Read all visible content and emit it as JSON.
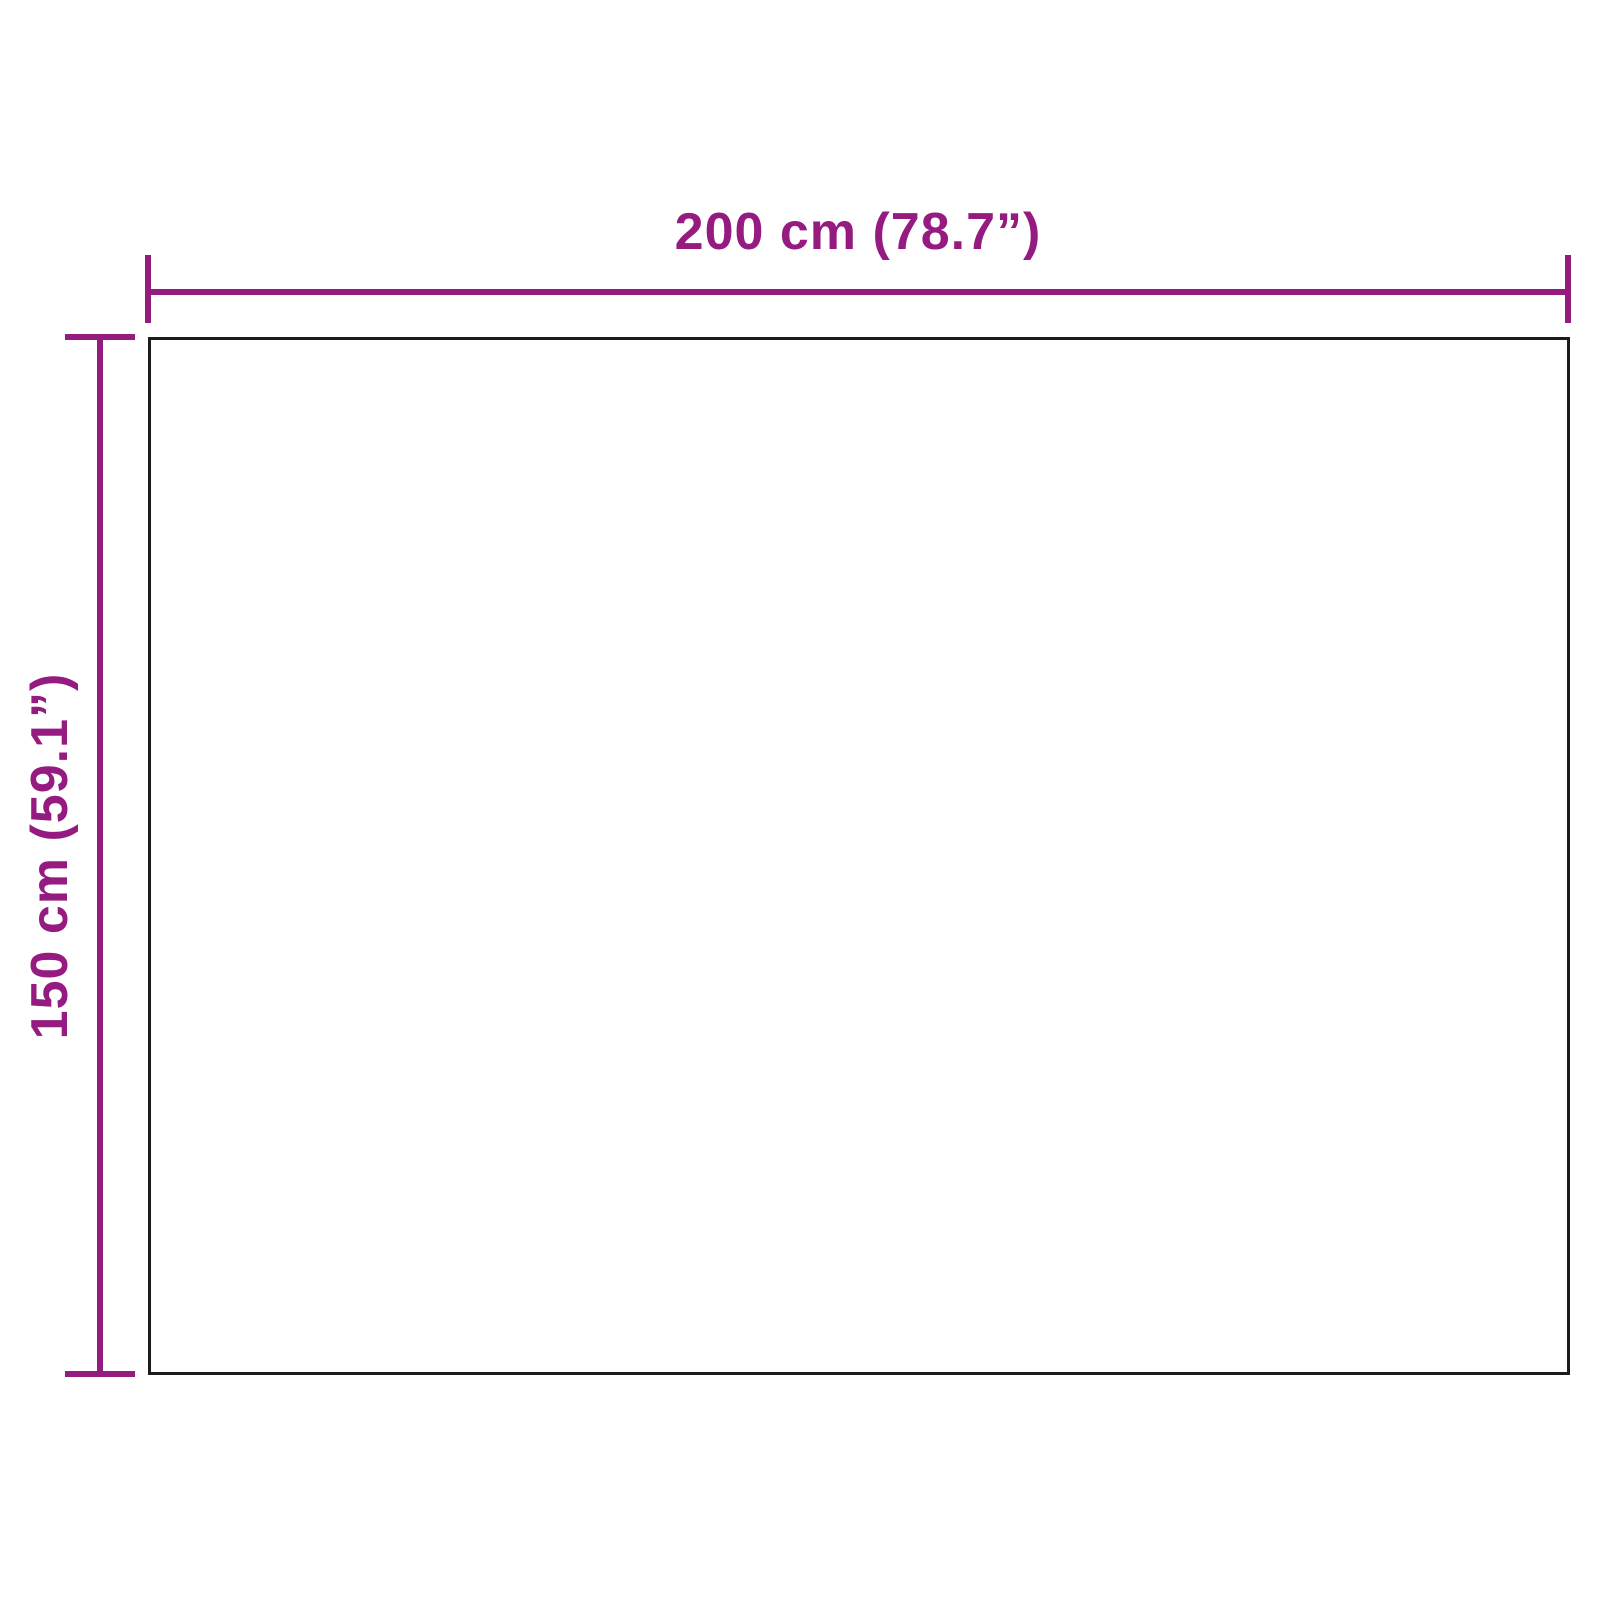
{
  "diagram": {
    "type": "product-dimension-diagram",
    "width_label": "200 cm (78.7”)",
    "height_label": "150 cm (59.1”)",
    "colors": {
      "dimension": "#951B81",
      "outline": "#1c1c1c",
      "background": "#ffffff"
    }
  }
}
